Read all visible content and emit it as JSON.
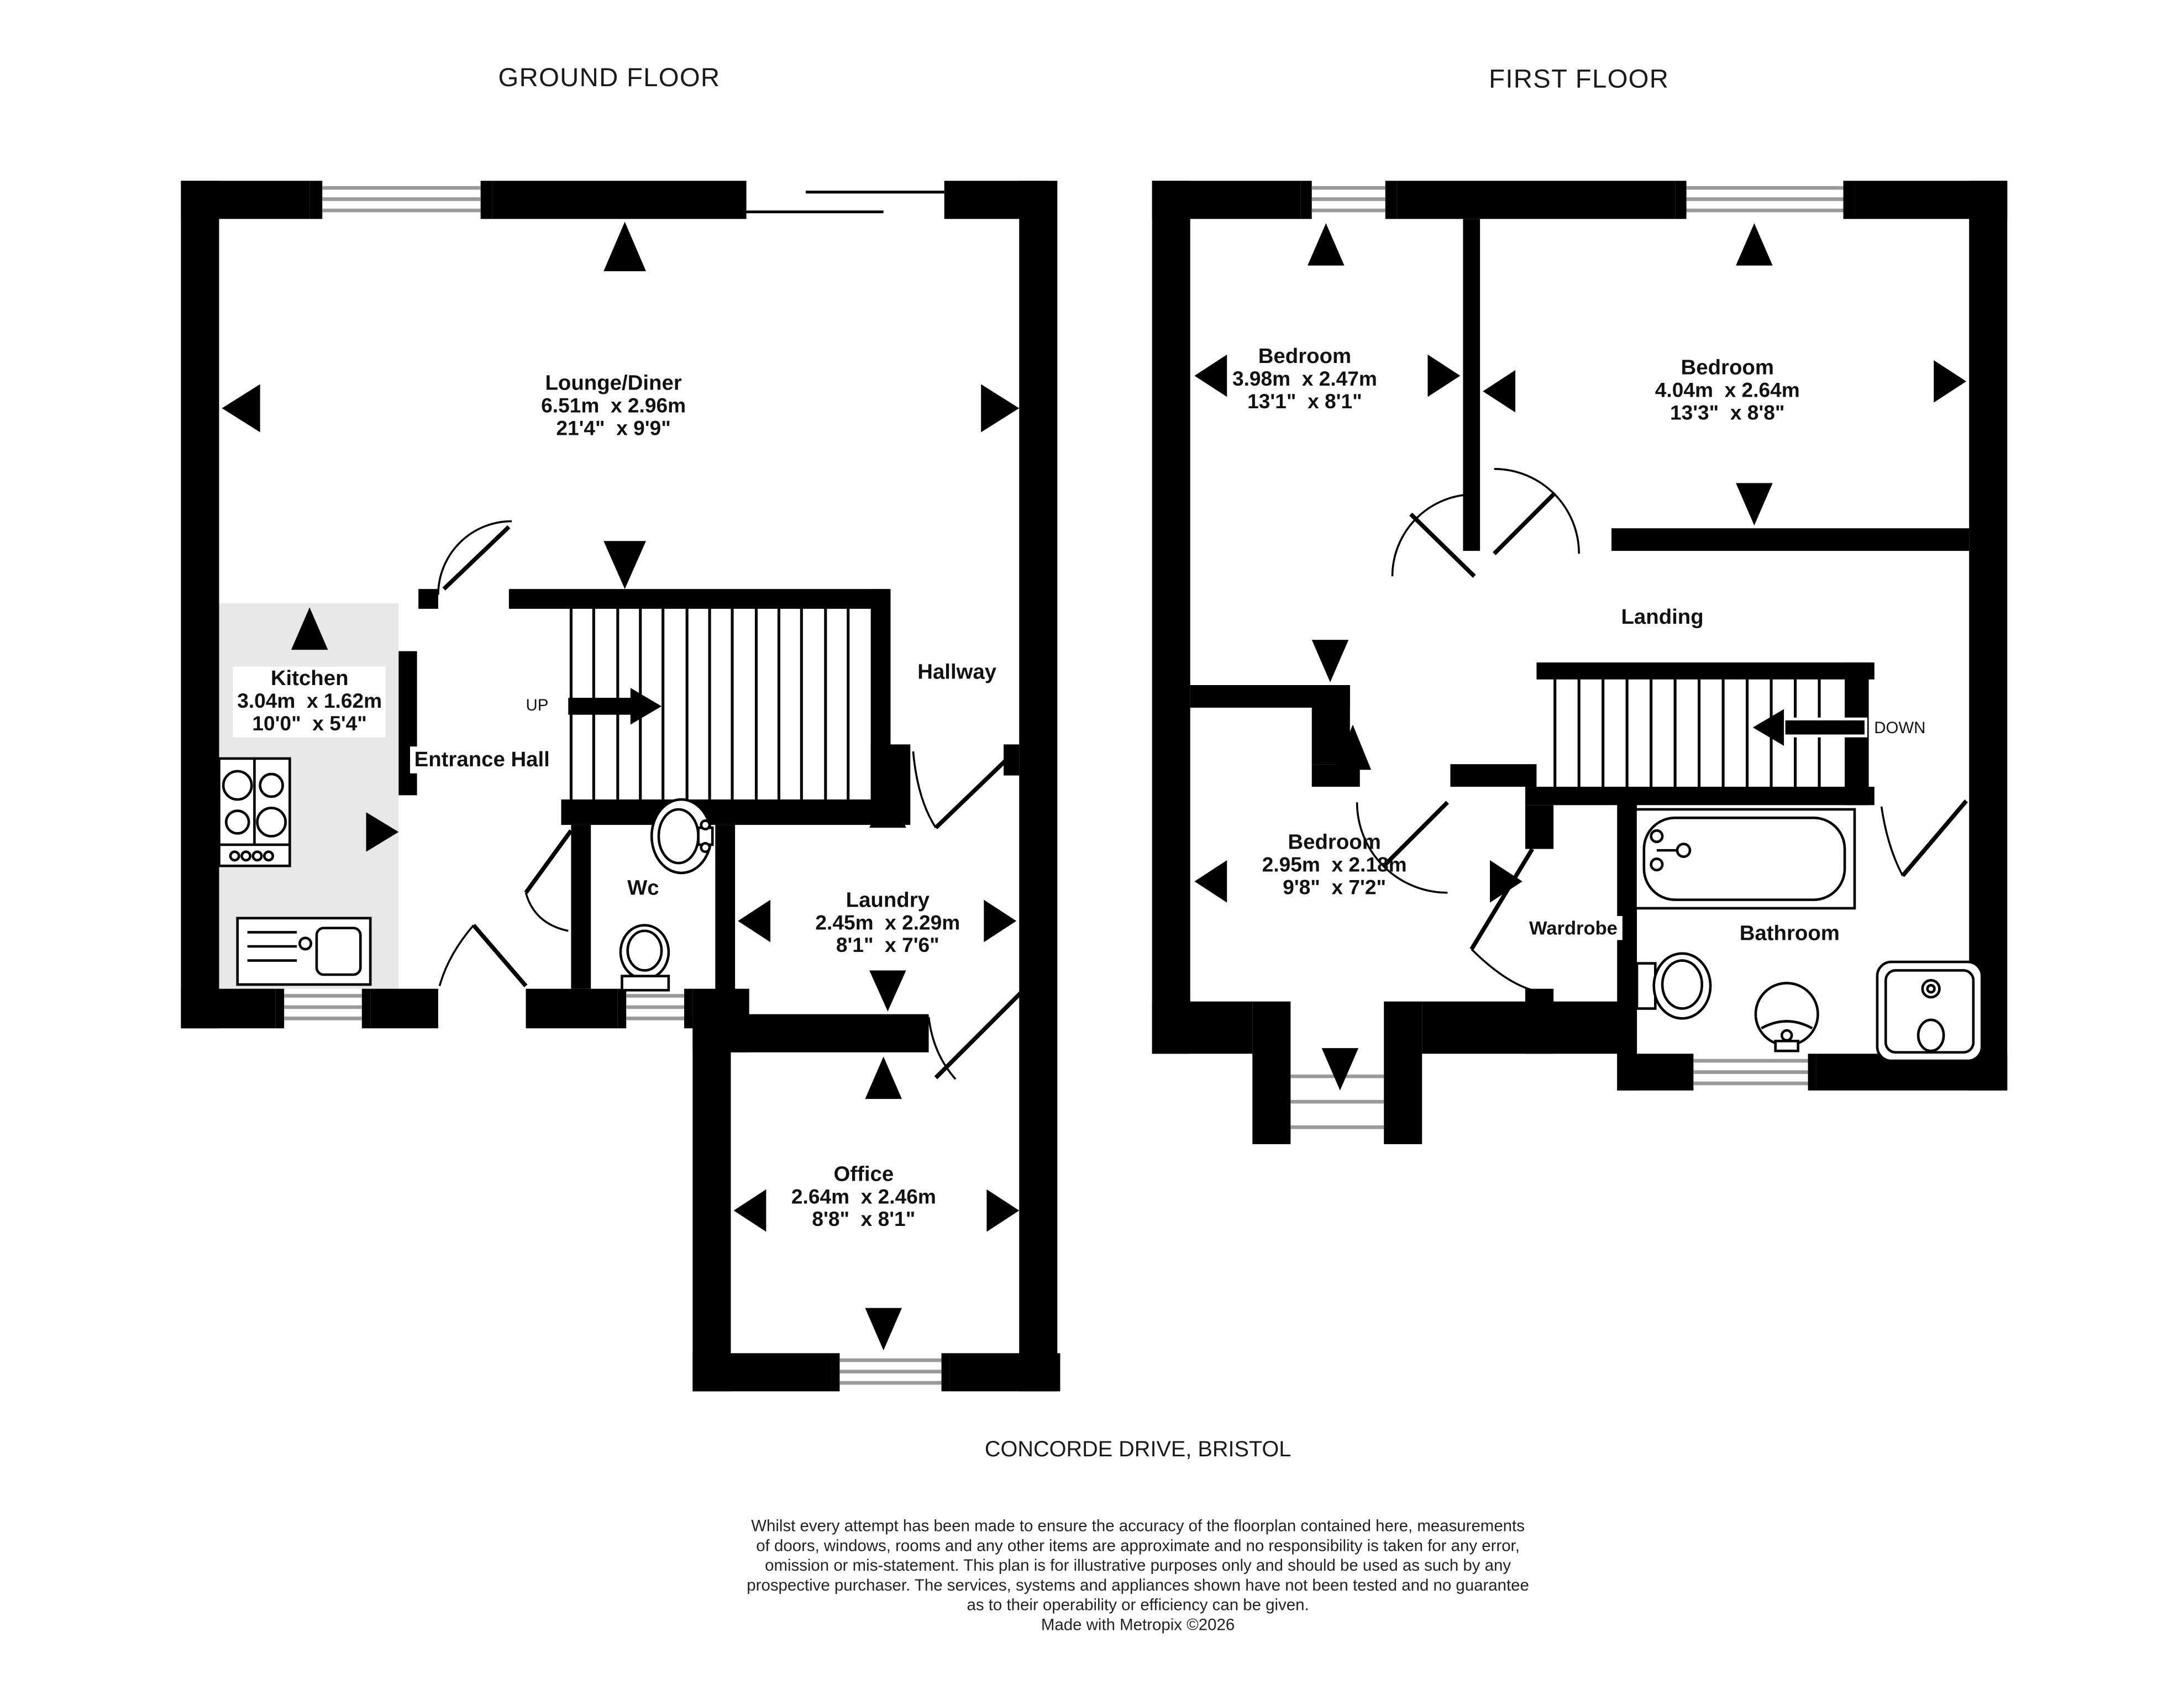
{
  "ground": {
    "title": "GROUND FLOOR",
    "stair_direction": "UP",
    "rooms": {
      "lounge": {
        "name": "Lounge/Diner",
        "metric": "6.51m  x 2.96m",
        "imperial": "21'4\"  x 9'9\""
      },
      "kitchen": {
        "name": "Kitchen",
        "metric": "3.04m  x 1.62m",
        "imperial": "10'0\"  x 5'4\""
      },
      "entrance_hall": {
        "name": "Entrance Hall"
      },
      "hallway": {
        "name": "Hallway"
      },
      "wc": {
        "name": "Wc"
      },
      "laundry": {
        "name": "Laundry",
        "metric": "2.45m  x 2.29m",
        "imperial": "8'1\"  x 7'6\""
      },
      "office": {
        "name": "Office",
        "metric": "2.64m  x 2.46m",
        "imperial": "8'8\"  x 8'1\""
      }
    }
  },
  "first": {
    "title": "FIRST FLOOR",
    "stair_direction": "DOWN",
    "rooms": {
      "bedroom_1": {
        "name": "Bedroom",
        "metric": "3.98m  x 2.47m",
        "imperial": "13'1\"  x 8'1\""
      },
      "bedroom_2": {
        "name": "Bedroom",
        "metric": "4.04m  x 2.64m",
        "imperial": "13'3\"  x 8'8\""
      },
      "bedroom_3": {
        "name": "Bedroom",
        "metric": "2.95m  x 2.18m",
        "imperial": "9'8\"  x 7'2\""
      },
      "landing": {
        "name": "Landing"
      },
      "wardrobe": {
        "name": "Wardrobe"
      },
      "bathroom": {
        "name": "Bathroom"
      }
    }
  },
  "footer": {
    "address": "CONCORDE DRIVE, BRISTOL",
    "disclaimer_lines": [
      "Whilst every attempt has been made to ensure the accuracy of the floorplan contained here, measurements",
      "of doors, windows, rooms and any other items are approximate and no responsibility is taken for any error,",
      "omission or mis-statement. This plan is for illustrative purposes only and should be used as such by any",
      "prospective purchaser. The services, systems and appliances shown have not been tested and no guarantee",
      "as to their operability or efficiency can be given.",
      "Made with Metropix ©2026"
    ]
  },
  "colors": {
    "wall": "#000000",
    "kitchen_floor": "#e8e8e8",
    "window_line": "#9a9a9a"
  }
}
